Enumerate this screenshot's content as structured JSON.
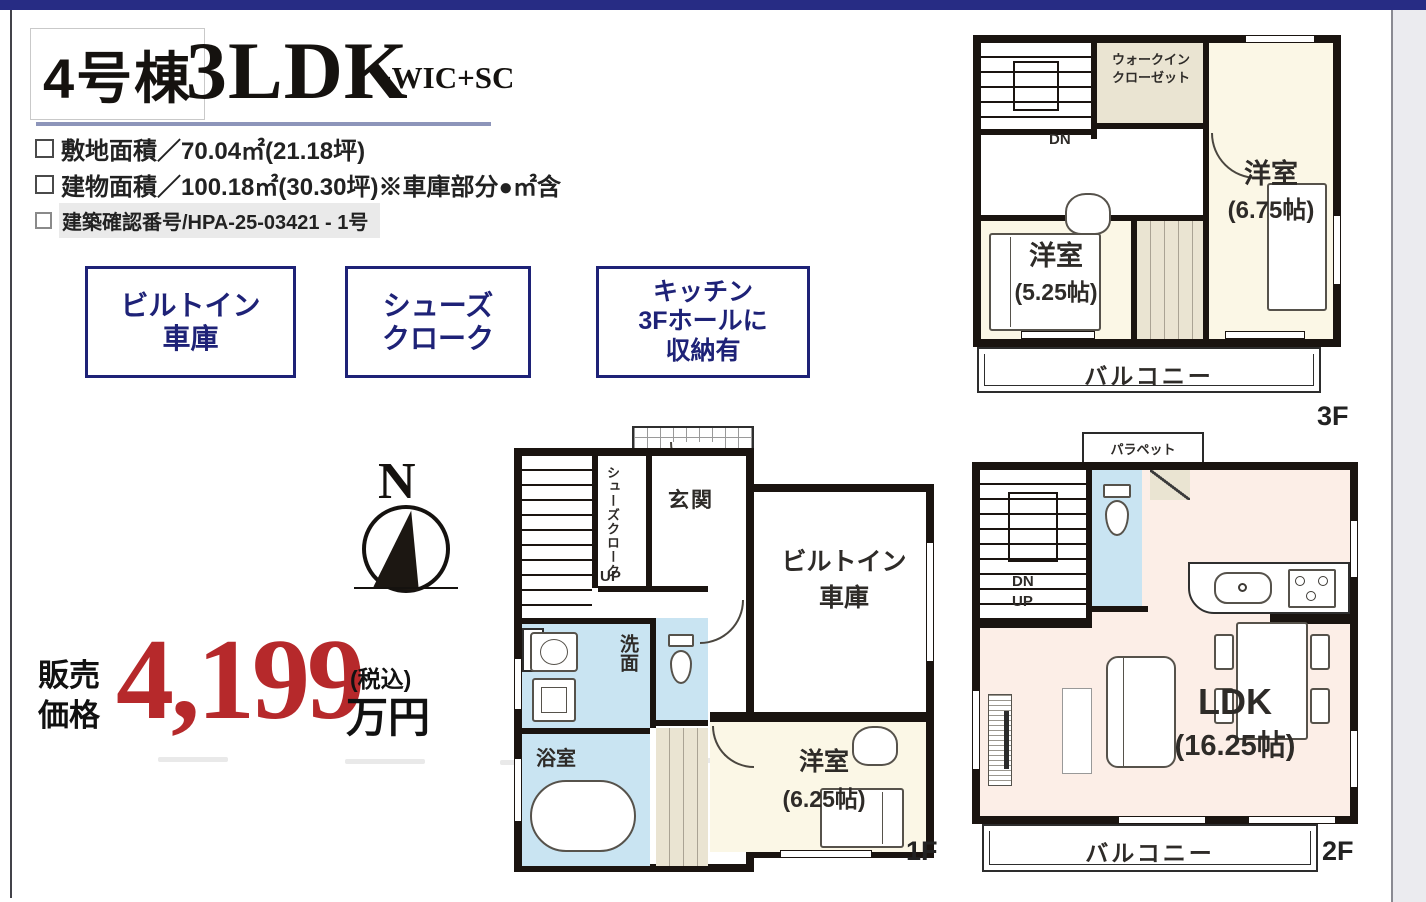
{
  "page": {
    "top_bar_color": "#272c84",
    "accent_navy": "#1e2277",
    "price_red": "#b6292b"
  },
  "header": {
    "unit": "4号棟",
    "plan": "3LDK",
    "plan_suffix": "+WIC+SC",
    "spec1": "敷地面積／70.04㎡(21.18坪)",
    "spec2": "建物面積／100.18㎡(30.30坪)※車庫部分●㎡含",
    "spec3": "建築確認番号/HPA-25-03421 - 1号"
  },
  "features": [
    {
      "l1": "ビルトイン",
      "l2": "車庫"
    },
    {
      "l1": "シューズ",
      "l2": "クローク"
    },
    {
      "l1": "キッチン",
      "l2": "3Fホールに",
      "l3": "収納有"
    }
  ],
  "price": {
    "caption1": "販売",
    "caption2": "価格",
    "amount": "4,199",
    "tax": "(税込)",
    "unit": "万円"
  },
  "compass": {
    "n": "N"
  },
  "floors": {
    "f1": {
      "label": "1F",
      "entrance": "玄関",
      "shoe_closet": "シューズクローク",
      "up": "UP",
      "ps": "PS",
      "washroom": "洗面",
      "bathroom": "浴室",
      "garage1": "ビルトイン",
      "garage2": "車庫",
      "room": "洋室",
      "room_size": "(6.25帖)"
    },
    "f2": {
      "label": "2F",
      "parapet": "パラペット",
      "dn": "DN",
      "up": "UP",
      "ldk": "LDK",
      "ldk_size": "(16.25帖)",
      "balcony": "バルコニー"
    },
    "f3": {
      "label": "3F",
      "dn": "DN",
      "wic1": "ウォークイン",
      "wic2": "クローゼット",
      "room_right": "洋室",
      "room_right_size": "(6.75帖)",
      "room_left": "洋室",
      "room_left_size": "(5.25帖)",
      "balcony": "バルコニー"
    }
  }
}
